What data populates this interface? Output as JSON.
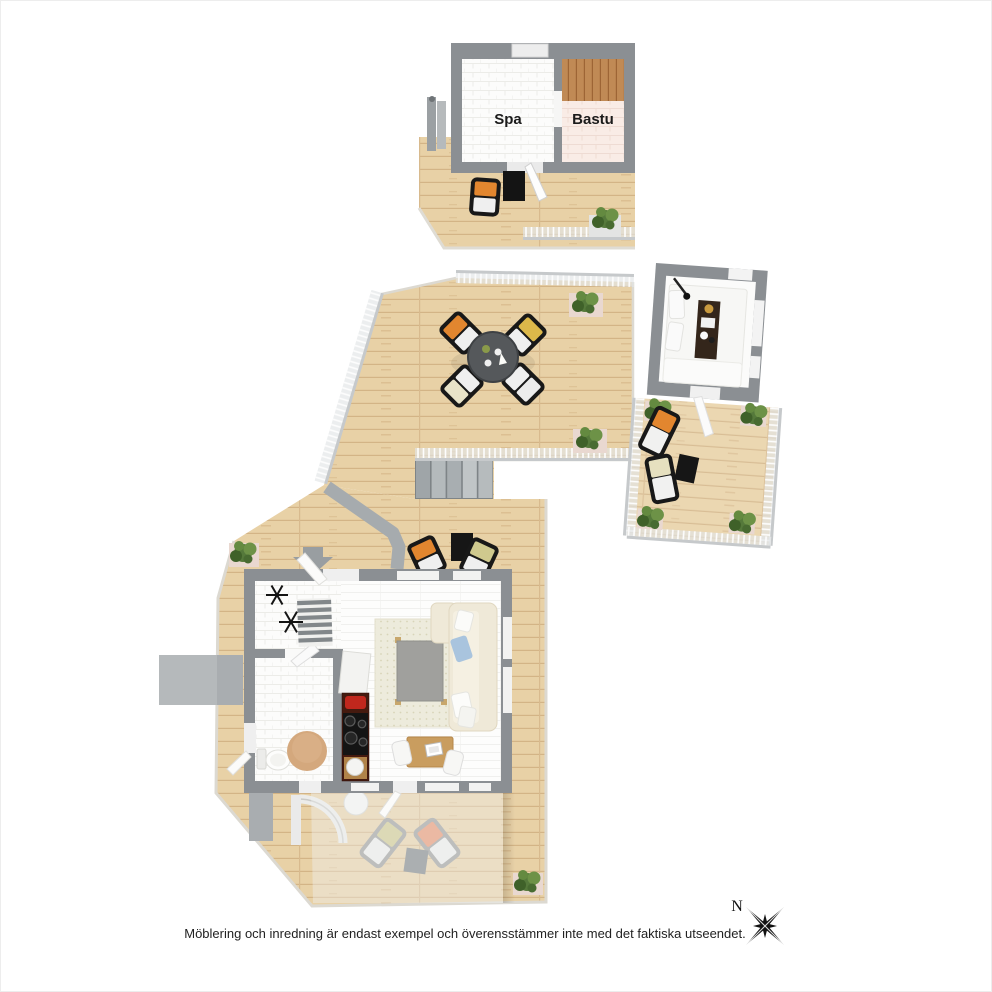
{
  "page": {
    "background_color": "#ffffff",
    "border_color": "#ededed"
  },
  "floorplan": {
    "type": "3d-floor-plan",
    "units": [
      {
        "id": "sauna-house",
        "description": "sauna building with deck",
        "rooms": [
          {
            "label": "Spa"
          },
          {
            "label": "Bastu"
          }
        ]
      },
      {
        "id": "roof-terrace",
        "description": "large wooden terrace with dining set and stairs",
        "rooms": []
      },
      {
        "id": "guest-bedroom",
        "description": "small bedroom building with terrace",
        "rooms": []
      },
      {
        "id": "main-cabin",
        "description": "main cabin with living room, kitchen, bathroom and large deck with pergola",
        "rooms": []
      }
    ]
  },
  "compass": {
    "label": "N"
  },
  "caption": "Möblering och inredning är endast exempel och överensstämmer inte med det faktiska utseendet.",
  "palette": {
    "wall_gray": "#8b8f93",
    "deck_wood": "#e8d1a6",
    "deck_line": "#d3b486",
    "bastu_wood": "#c08a55",
    "bastu_floor": "#f9ece6",
    "spa_tile": "#fcfcfb",
    "kitchen_counter": "#451a0f",
    "kettle_red": "#c0271d",
    "cushion_orange": "#e2862f",
    "cushion_yellow": "#dcb84a",
    "cushion_olive": "#cfc98e",
    "cushion_salmon": "#e8926e",
    "pillow_blue": "#a9c4de",
    "sofa_cream": "#efe9d8",
    "rug_beige": "#edebdc",
    "plant_green": "#55793b",
    "planter_pink": "#e9d8d0",
    "path_gray": "#a6abae",
    "compass_black": "#111111"
  }
}
